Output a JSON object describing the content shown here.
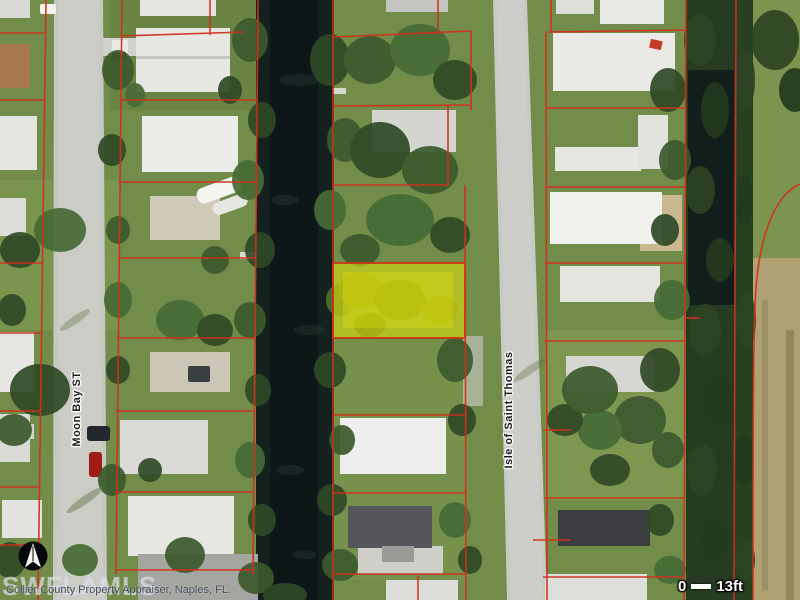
{
  "map": {
    "street_labels": [
      {
        "name": "Moon Bay ST"
      },
      {
        "name": "Isle of Saint Thomas"
      }
    ],
    "scale_bar": {
      "start": "0",
      "label": "13ft"
    },
    "attribution": "Collier County Property Appraiser, Naples, FL.",
    "watermark": "SWFLAMLS",
    "colors": {
      "parcel_line": "#d2301c",
      "highlight_fill": "#e8e80a",
      "highlight_border": "#cc3512",
      "water": "#15211f",
      "road": "#c7c7c3",
      "grass": "#728c49"
    }
  }
}
